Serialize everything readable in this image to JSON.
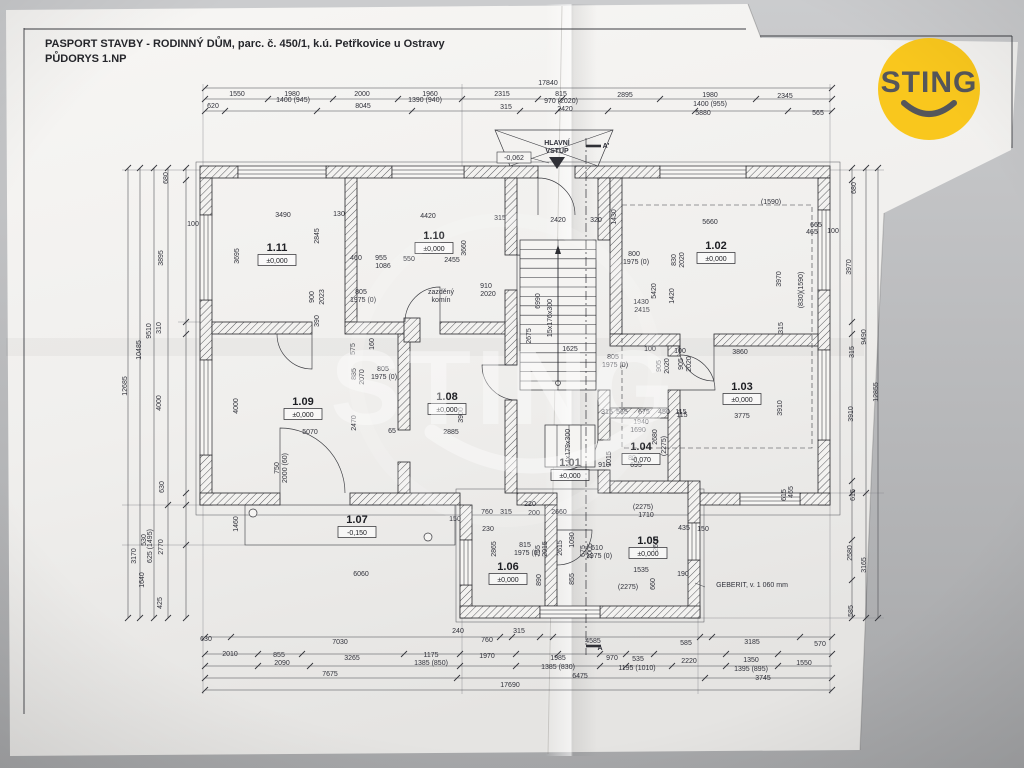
{
  "header": {
    "line1": "PASPORT STAVBY - RODINNÝ DŮM, parc. č. 450/1, k.ú. Petřkovice u Ostravy",
    "line2": "PŮDORYS 1.NP"
  },
  "logo": {
    "text": "STING",
    "circle_color": "#F9C71D",
    "text_color": "#55565A"
  },
  "watermark": {
    "text": "STING"
  },
  "plan": {
    "rooms": [
      {
        "id": "1.11",
        "elev": "±0,000",
        "x": 277,
        "y": 251
      },
      {
        "id": "1.10",
        "elev": "±0,000",
        "x": 434,
        "y": 239
      },
      {
        "id": "1.02",
        "elev": "±0,000",
        "x": 716,
        "y": 249
      },
      {
        "id": "1.09",
        "elev": "±0,000",
        "x": 303,
        "y": 405
      },
      {
        "id": "1.08",
        "elev": "±0,000",
        "x": 447,
        "y": 400
      },
      {
        "id": "1.03",
        "elev": "±0,000",
        "x": 742,
        "y": 390
      },
      {
        "id": "1.01",
        "elev": "±0,000",
        "x": 570,
        "y": 466
      },
      {
        "id": "1.04",
        "elev": "-0,070",
        "x": 641,
        "y": 450
      },
      {
        "id": "1.05",
        "elev": "±0,000",
        "x": 648,
        "y": 544
      },
      {
        "id": "1.06",
        "elev": "±0,000",
        "x": 508,
        "y": 570
      },
      {
        "id": "1.07",
        "elev": "-0,150",
        "x": 357,
        "y": 523
      }
    ],
    "annotations": [
      [
        "17840",
        548,
        85
      ],
      [
        "1550",
        237,
        96
      ],
      [
        "1980",
        292,
        96
      ],
      [
        "2000",
        362,
        96
      ],
      [
        "1960",
        430,
        96
      ],
      [
        "2315",
        502,
        96
      ],
      [
        "815",
        561,
        96
      ],
      [
        "2895",
        625,
        97
      ],
      [
        "1980",
        710,
        97
      ],
      [
        "2345",
        785,
        98
      ],
      [
        "620",
        213,
        108
      ],
      [
        "1400 (945)",
        293,
        102
      ],
      [
        "8045",
        363,
        108
      ],
      [
        "1390 (940)",
        425,
        102
      ],
      [
        "315",
        506,
        109
      ],
      [
        "970 (2020)",
        561,
        103
      ],
      [
        "2420",
        565,
        111
      ],
      [
        "1400 (955)",
        710,
        106
      ],
      [
        "5880",
        703,
        115
      ],
      [
        "565",
        818,
        115
      ],
      [
        "630",
        206,
        641
      ],
      [
        "7030",
        340,
        644
      ],
      [
        "240",
        458,
        633
      ],
      [
        "760",
        487,
        642
      ],
      [
        "315",
        519,
        633
      ],
      [
        "4585",
        593,
        643
      ],
      [
        "585",
        686,
        645
      ],
      [
        "3185",
        752,
        644
      ],
      [
        "570",
        820,
        646
      ],
      [
        "2010",
        230,
        656
      ],
      [
        "855",
        279,
        657
      ],
      [
        "3265",
        352,
        660
      ],
      [
        "1175",
        431,
        657
      ],
      [
        "1970",
        487,
        658
      ],
      [
        "1985",
        558,
        660
      ],
      [
        "970",
        612,
        660
      ],
      [
        "535",
        638,
        661
      ],
      [
        "2220",
        689,
        663
      ],
      [
        "1350",
        751,
        662
      ],
      [
        "1550",
        804,
        665
      ],
      [
        "2090",
        282,
        665
      ],
      [
        "1385 (850)",
        431,
        665
      ],
      [
        "1385 (830)",
        558,
        669
      ],
      [
        "1195 (1010)",
        637,
        670
      ],
      [
        "1395 (895)",
        751,
        671
      ],
      [
        "7675",
        330,
        676
      ],
      [
        "6475",
        580,
        678
      ],
      [
        "3745",
        763,
        680
      ],
      [
        "17690",
        510,
        687
      ],
      [
        "680",
        168,
        178,
        -90
      ],
      [
        "3895",
        163,
        258,
        -90
      ],
      [
        "310",
        161,
        328,
        -90
      ],
      [
        "4000",
        161,
        403,
        -90
      ],
      [
        "630",
        164,
        487,
        -90
      ],
      [
        "2770",
        163,
        547,
        -90
      ],
      [
        "425",
        162,
        603,
        -90
      ],
      [
        "9510",
        151,
        331,
        -90
      ],
      [
        "10485",
        141,
        350,
        -90
      ],
      [
        "12685",
        127,
        386,
        -90
      ],
      [
        "530",
        146,
        540,
        -90
      ],
      [
        "625 (1495)",
        152,
        546,
        -90
      ],
      [
        "1640",
        144,
        580,
        -90
      ],
      [
        "3170",
        136,
        556,
        -90
      ],
      [
        "100",
        193,
        226
      ],
      [
        "1460",
        238,
        524,
        -90
      ],
      [
        "680",
        856,
        188,
        -90
      ],
      [
        "3970",
        851,
        267,
        -90
      ],
      [
        "315",
        854,
        352,
        -90
      ],
      [
        "3910",
        853,
        414,
        -90
      ],
      [
        "9490",
        866,
        337,
        -90
      ],
      [
        "12855",
        878,
        392,
        -90
      ],
      [
        "615",
        855,
        495,
        -90
      ],
      [
        "2580",
        852,
        553,
        -90
      ],
      [
        "585",
        853,
        611,
        -90
      ],
      [
        "3165",
        866,
        565,
        -90
      ],
      [
        "3490",
        283,
        217
      ],
      [
        "130",
        339,
        216
      ],
      [
        "3695",
        239,
        256,
        -90
      ],
      [
        "2845",
        319,
        236,
        -90
      ],
      [
        "900",
        314,
        297,
        -90
      ],
      [
        "2023",
        324,
        297,
        -90
      ],
      [
        "390",
        319,
        321,
        -90
      ],
      [
        "4420",
        428,
        218
      ],
      [
        "315",
        500,
        220
      ],
      [
        "3660",
        466,
        248,
        -90
      ],
      [
        "2455",
        452,
        262
      ],
      [
        "460",
        356,
        260
      ],
      [
        "955",
        381,
        260
      ],
      [
        "1086",
        383,
        268
      ],
      [
        "550",
        409,
        261
      ],
      [
        "805",
        361,
        294
      ],
      [
        "1975 (0)",
        363,
        302
      ],
      [
        "910",
        486,
        288
      ],
      [
        "2020",
        488,
        296
      ],
      [
        "zazděný",
        441,
        294,
        0,
        6.5
      ],
      [
        "komín",
        441,
        302,
        0,
        6.5
      ],
      [
        "5660",
        710,
        224
      ],
      [
        "(1590)",
        771,
        204
      ],
      [
        "665",
        816,
        227
      ],
      [
        "465",
        812,
        234
      ],
      [
        "100",
        833,
        233
      ],
      [
        "800",
        634,
        256
      ],
      [
        "1975 (0)",
        636,
        264
      ],
      [
        "830",
        676,
        260,
        -90
      ],
      [
        "2020",
        684,
        260,
        -90
      ],
      [
        "5420",
        656,
        291,
        -90
      ],
      [
        "1420",
        674,
        296,
        -90
      ],
      [
        "1430",
        641,
        304
      ],
      [
        "2415",
        642,
        312
      ],
      [
        "3970",
        781,
        279,
        -90
      ],
      [
        "(830)(1590)",
        803,
        290,
        -90
      ],
      [
        "315",
        783,
        328,
        -90
      ],
      [
        "1430",
        616,
        217,
        -90
      ],
      [
        "2420",
        558,
        222
      ],
      [
        "320",
        596,
        222
      ],
      [
        "15x176x300",
        552,
        318,
        -90,
        6.5
      ],
      [
        "2675",
        531,
        336,
        -90
      ],
      [
        "6990",
        540,
        301,
        -90
      ],
      [
        "1625",
        570,
        351
      ],
      [
        "805",
        613,
        359
      ],
      [
        "1975 (0)",
        615,
        367
      ],
      [
        "100",
        650,
        351
      ],
      [
        "905",
        661,
        366,
        -90
      ],
      [
        "2020",
        669,
        366,
        -90
      ],
      [
        "4x179x300",
        570,
        446,
        -90,
        6.5
      ],
      [
        "575",
        355,
        349,
        -90
      ],
      [
        "160",
        374,
        344,
        -90
      ],
      [
        "885",
        356,
        374,
        -90
      ],
      [
        "2070",
        364,
        377,
        -90
      ],
      [
        "805",
        383,
        371
      ],
      [
        "1975 (0)",
        384,
        379
      ],
      [
        "4000",
        238,
        406,
        -90
      ],
      [
        "5070",
        310,
        434
      ],
      [
        "2470",
        356,
        423,
        -90
      ],
      [
        "65",
        392,
        433
      ],
      [
        "2885",
        451,
        434
      ],
      [
        "3900",
        463,
        415,
        -90
      ],
      [
        "750",
        279,
        468,
        -90
      ],
      [
        "2000 (60)",
        287,
        468,
        -90
      ],
      [
        "100",
        680,
        353
      ],
      [
        "3860",
        740,
        354
      ],
      [
        "905",
        683,
        364,
        -90
      ],
      [
        "2020",
        691,
        364,
        -90
      ],
      [
        "115",
        682,
        417
      ],
      [
        "3775",
        742,
        418
      ],
      [
        "3910",
        782,
        408,
        -90
      ],
      [
        "465",
        793,
        492,
        -90
      ],
      [
        "615",
        786,
        495,
        -90
      ],
      [
        "315",
        607,
        414
      ],
      [
        "565",
        622,
        414
      ],
      [
        "675",
        644,
        414
      ],
      [
        "450",
        664,
        414
      ],
      [
        "115",
        681,
        414
      ],
      [
        "1940",
        641,
        424
      ],
      [
        "1690",
        638,
        432
      ],
      [
        "2680",
        657,
        437,
        -90
      ],
      [
        "(2275)",
        666,
        446,
        -90
      ],
      [
        "910",
        604,
        467
      ],
      [
        "1015",
        611,
        459,
        -90
      ],
      [
        "80",
        632,
        460
      ],
      [
        "695",
        636,
        467
      ],
      [
        "220",
        530,
        506
      ],
      [
        "200",
        534,
        515
      ],
      [
        "2660",
        559,
        514
      ],
      [
        "1090",
        574,
        540,
        -90
      ],
      [
        "(2275)",
        643,
        509
      ],
      [
        "1710",
        646,
        517
      ],
      [
        "610",
        597,
        550
      ],
      [
        "1975 (0)",
        599,
        558
      ],
      [
        "815",
        525,
        547
      ],
      [
        "1975 (0)",
        527,
        555
      ],
      [
        "755",
        540,
        551,
        -90
      ],
      [
        "2015",
        547,
        549,
        -90
      ],
      [
        "2615",
        562,
        548,
        -90
      ],
      [
        "675",
        585,
        551,
        -90
      ],
      [
        "2005",
        592,
        551,
        -90
      ],
      [
        "890",
        541,
        580,
        -90
      ],
      [
        "855",
        574,
        579,
        -90
      ],
      [
        "660",
        655,
        584,
        -90
      ],
      [
        "1535",
        641,
        572
      ],
      [
        "190",
        683,
        576
      ],
      [
        "(2275)",
        628,
        589
      ],
      [
        "435",
        684,
        530
      ],
      [
        "150",
        703,
        531
      ],
      [
        "2600",
        658,
        544,
        -90
      ],
      [
        "230",
        488,
        531
      ],
      [
        "2865",
        496,
        549,
        -90
      ],
      [
        "315",
        506,
        514
      ],
      [
        "760",
        487,
        514
      ],
      [
        "150",
        455,
        521
      ],
      [
        "6060",
        361,
        576
      ],
      [
        "GEBERIT, v. 1 060 mm",
        752,
        587,
        0,
        7
      ],
      [
        "HLAVNÍ",
        557,
        145,
        0,
        6.5,
        1
      ],
      [
        "VSTUP",
        557,
        153,
        0,
        6.5,
        1
      ],
      [
        "-0,062",
        514,
        160,
        0,
        6.5
      ],
      [
        "A'",
        606,
        148,
        0,
        10,
        1
      ],
      [
        "A",
        600,
        650,
        0,
        10,
        1
      ]
    ]
  }
}
